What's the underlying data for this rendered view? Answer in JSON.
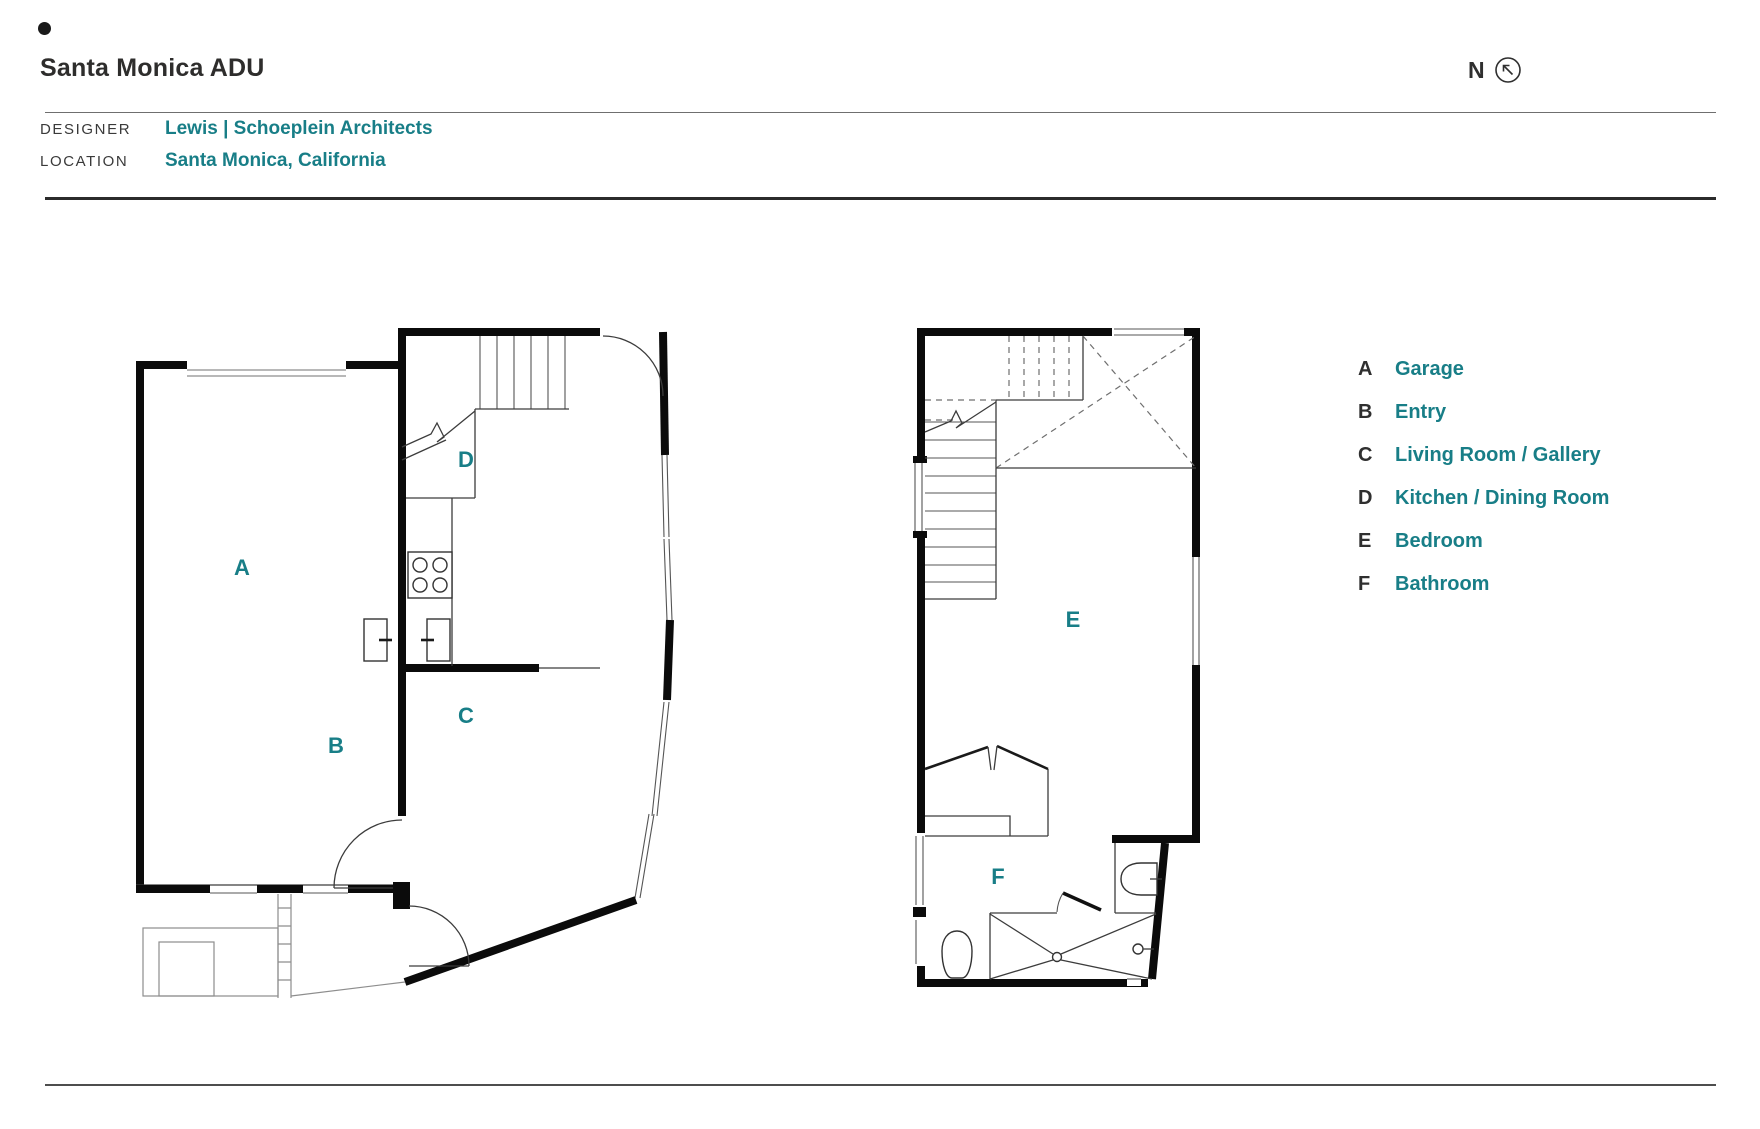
{
  "header": {
    "title": "Santa Monica ADU",
    "designer_label": "DESIGNER",
    "designer_value": "Lewis | Schoeplein Architects",
    "location_label": "LOCATION",
    "location_value": "Santa Monica, California"
  },
  "compass": {
    "label": "N"
  },
  "legend": {
    "items": [
      {
        "key": "A",
        "name": "Garage"
      },
      {
        "key": "B",
        "name": "Entry"
      },
      {
        "key": "C",
        "name": "Living Room / Gallery"
      },
      {
        "key": "D",
        "name": "Kitchen / Dining Room"
      },
      {
        "key": "E",
        "name": "Bedroom"
      },
      {
        "key": "F",
        "name": "Bathroom"
      }
    ]
  },
  "plans": {
    "first": {
      "labels": [
        "A",
        "B",
        "C",
        "D"
      ]
    },
    "second": {
      "labels": [
        "E",
        "F"
      ]
    }
  },
  "colors": {
    "accent": "#187e87",
    "wall": "#0b0b0b"
  }
}
